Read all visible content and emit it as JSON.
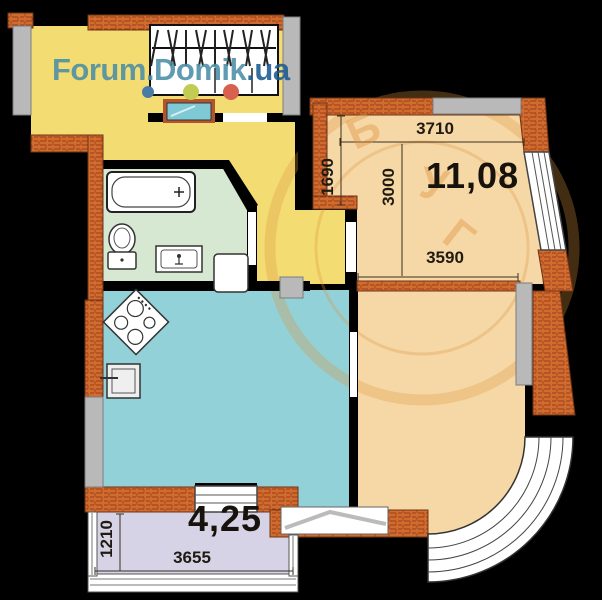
{
  "watermark": {
    "site_prefix": "Forum.Domik",
    "site_suffix": ".ua",
    "stamp_letters": [
      "Б",
      "У",
      "Г"
    ]
  },
  "plan": {
    "rooms": {
      "bedroom": {
        "area": "11,08",
        "dim_top": "3710",
        "dim_left": "1690",
        "dim_height": "3000",
        "dim_bottom": "3590"
      },
      "balcony": {
        "area": "4,25",
        "dim_left": "1210",
        "dim_bottom": "3655"
      }
    },
    "palette": {
      "hallway_yellow": "#f3dc72",
      "bathroom_mint": "#d6e7d2",
      "bedroom_tan": "#f6d8a7",
      "kitchen_teal": "#93d1d8",
      "balcony_lavender": "#d7d3e7",
      "brick_orange": "#cf6c2e",
      "brick_mortar": "#9c3b1b",
      "concrete_gray": "#b9b9b9",
      "wall_black": "#000000",
      "watermark_teal": "#4b8ea8",
      "watermark_blue": "#1a5a91",
      "stamp_orange": "#de943e"
    }
  }
}
